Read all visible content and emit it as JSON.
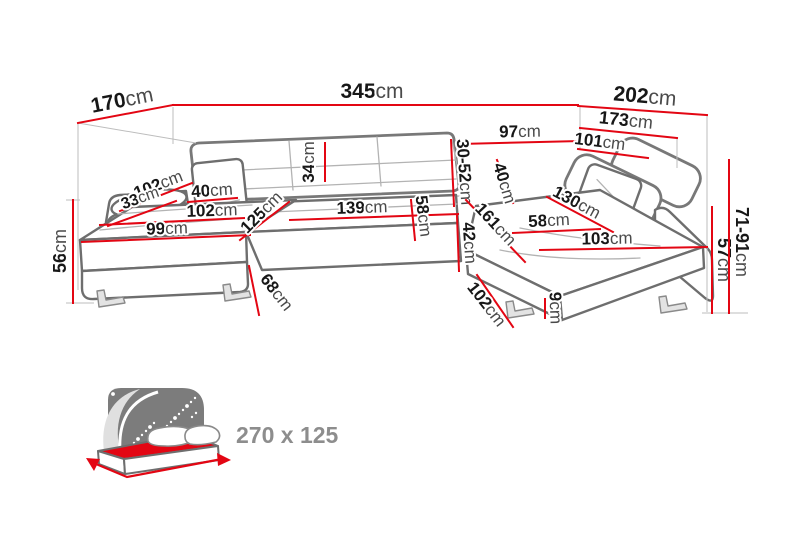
{
  "unit": "cm",
  "colors": {
    "dimension_red": "#e30613",
    "label_number": "#171717",
    "label_unit": "#4a4a4a",
    "sofa_outline": "#6e6e6e",
    "bed_headboard": "#7c7c7c",
    "bed_mattress_red": "#e30613",
    "bed_text_gray": "#8d8d8d"
  },
  "dimensions": [
    {
      "name": "left-depth",
      "num": "170",
      "line": [
        78,
        123,
        173,
        105
      ],
      "lx": 122,
      "ly": 100,
      "rot": -11,
      "size": 21
    },
    {
      "name": "total-width",
      "num": "345",
      "line": [
        173,
        105,
        578,
        105
      ],
      "lx": 372,
      "ly": 91,
      "rot": 0,
      "size": 21
    },
    {
      "name": "right-depth",
      "num": "202",
      "line": [
        578,
        106,
        707,
        115
      ],
      "lx": 645,
      "ly": 96,
      "rot": 5,
      "size": 21
    },
    {
      "name": "right-inner-depth",
      "num": "173",
      "line": [
        580,
        128,
        677,
        138
      ],
      "lx": 626,
      "ly": 120,
      "rot": 6,
      "size": 18
    },
    {
      "name": "back-width-right",
      "num": "97",
      "line": [
        460,
        144,
        580,
        141
      ],
      "lx": 520,
      "ly": 131,
      "rot": -1,
      "size": 17
    },
    {
      "name": "right-depth-upper",
      "num": "101",
      "line": [
        578,
        149,
        648,
        158
      ],
      "lx": 600,
      "ly": 141,
      "rot": 7,
      "size": 17
    },
    {
      "name": "backrest-height",
      "num": "34",
      "line": [
        325,
        143,
        325,
        181
      ],
      "lx": 308,
      "ly": 162,
      "rot": -90,
      "size": 17
    },
    {
      "name": "headrest-range",
      "num": "30-52",
      "line": [
        451,
        140,
        454,
        206
      ],
      "lx": 465,
      "ly": 172,
      "rot": 86,
      "size": 17
    },
    {
      "name": "arm-pillow-length",
      "num": "102",
      "line": [
        120,
        211,
        192,
        183
      ],
      "lx": 158,
      "ly": 184,
      "rot": -21,
      "size": 17
    },
    {
      "name": "arm-pillow-height",
      "num": "33",
      "line": [
        108,
        226,
        176,
        201
      ],
      "lx": 140,
      "ly": 198,
      "rot": -20,
      "size": 16
    },
    {
      "name": "pillow-width-left",
      "num": "40",
      "line": [
        188,
        202,
        237,
        198
      ],
      "lx": 212,
      "ly": 190,
      "rot": -4,
      "size": 17
    },
    {
      "name": "left-seat-length",
      "num": "102",
      "line": [
        100,
        225,
        244,
        218
      ],
      "lx": 212,
      "ly": 210,
      "rot": -2,
      "size": 17
    },
    {
      "name": "left-seat-width",
      "num": "99",
      "line": [
        82,
        242,
        250,
        235
      ],
      "lx": 167,
      "ly": 228,
      "rot": -2,
      "size": 17
    },
    {
      "name": "left-seat-diagonal",
      "num": "125",
      "line": [
        240,
        240,
        289,
        202
      ],
      "lx": 261,
      "ly": 212,
      "rot": -45,
      "size": 17
    },
    {
      "name": "middle-seat-length",
      "num": "139",
      "line": [
        290,
        220,
        458,
        214
      ],
      "lx": 362,
      "ly": 207,
      "rot": -2,
      "size": 17
    },
    {
      "name": "middle-seat-depth",
      "num": "58",
      "line": [
        411,
        200,
        415,
        240
      ],
      "lx": 424,
      "ly": 216,
      "rot": 83,
      "size": 17
    },
    {
      "name": "seat-height-middle",
      "num": "42",
      "line": [
        457,
        216,
        459,
        271
      ],
      "lx": 470,
      "ly": 243,
      "rot": 86,
      "size": 17
    },
    {
      "name": "right-seat-length",
      "num": "161",
      "line": [
        466,
        200,
        525,
        262
      ],
      "lx": 496,
      "ly": 224,
      "rot": 47,
      "size": 17
    },
    {
      "name": "pillow-width-right",
      "num": "40",
      "line": [
        497,
        160,
        513,
        203
      ],
      "lx": 505,
      "ly": 183,
      "rot": 73,
      "size": 17
    },
    {
      "name": "right-seat-width",
      "num": "58",
      "line": [
        513,
        233,
        600,
        229
      ],
      "lx": 549,
      "ly": 220,
      "rot": -3,
      "size": 17
    },
    {
      "name": "right-seat-diagonal",
      "num": "130",
      "line": [
        547,
        197,
        613,
        232
      ],
      "lx": 577,
      "ly": 202,
      "rot": 28,
      "size": 17
    },
    {
      "name": "right-front-length",
      "num": "103",
      "line": [
        540,
        250,
        707,
        247
      ],
      "lx": 607,
      "ly": 238,
      "rot": -1,
      "size": 17
    },
    {
      "name": "front-edge-height-left",
      "num": "68",
      "line": [
        249,
        266,
        259,
        315
      ],
      "lx": 277,
      "ly": 292,
      "rot": 52,
      "size": 17
    },
    {
      "name": "chaise-front-diagonal",
      "num": "102",
      "line": [
        477,
        275,
        513,
        327
      ],
      "lx": 487,
      "ly": 304,
      "rot": 52,
      "size": 17
    },
    {
      "name": "foot-height",
      "num": "9",
      "line": [
        545,
        299,
        545,
        318
      ],
      "lx": 556,
      "ly": 308,
      "rot": 88,
      "size": 17
    },
    {
      "name": "left-height",
      "num": "56",
      "line": [
        73,
        200,
        73,
        303
      ],
      "lx": 60,
      "ly": 251,
      "rot": -90,
      "size": 18
    },
    {
      "name": "armrest-height-right",
      "num": "57",
      "line": [
        712,
        207,
        712,
        313
      ],
      "lx": 724,
      "ly": 260,
      "rot": 90,
      "size": 18
    },
    {
      "name": "headrest-height-range",
      "num": "71-91",
      "line": [
        729,
        160,
        729,
        313
      ],
      "lx": 742,
      "ly": 242,
      "rot": 90,
      "size": 18
    }
  ],
  "bed": {
    "label": "270 x 125"
  }
}
